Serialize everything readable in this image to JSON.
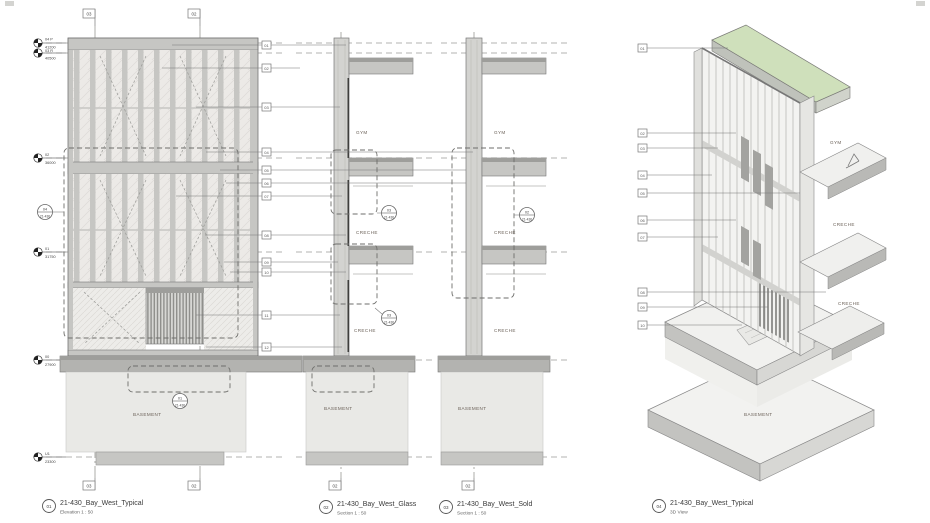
{
  "colors": {
    "roof_green": "#cfe0bb",
    "slab_gray": "#c6c6c3",
    "slab_dark": "#9e9e9b",
    "wall_fill": "#d3d3d0",
    "basement_fill": "#e9e9e6",
    "line": "#777777"
  },
  "levels": [
    {
      "name": "04 P",
      "elevation": "41200"
    },
    {
      "name": "03 R",
      "elevation": "40500"
    },
    {
      "name": "02",
      "elevation": "36000"
    },
    {
      "name": "01",
      "elevation": "31750"
    },
    {
      "name": "00",
      "elevation": "27900"
    },
    {
      "name": "U1",
      "elevation": "23300"
    }
  ],
  "grids": {
    "left": "03",
    "right": "02",
    "glass_axis": "02",
    "solid_axis": "02"
  },
  "rooms": {
    "gym": "GYM",
    "creche": "CRECHE",
    "basement": "BASEMENT"
  },
  "refs": [
    {
      "top": "04",
      "sheet": "21-430"
    },
    {
      "top": "01",
      "sheet": "21-430"
    },
    {
      "top": "03",
      "sheet": "21-430"
    },
    {
      "top": "03",
      "sheet": "21-430"
    },
    {
      "top": "02",
      "sheet": "21-430"
    }
  ],
  "keynotes_sections": [
    "01",
    "02",
    "03",
    "04",
    "05",
    "06",
    "07",
    "08",
    "09",
    "10",
    "11",
    "12"
  ],
  "keynotes_3d": [
    "01",
    "02",
    "03",
    "04",
    "05",
    "06",
    "07",
    "08",
    "09",
    "10"
  ],
  "titles": [
    {
      "num": "01",
      "name": "21-430_Bay_West_Typical",
      "sub": "Elevation  1 : 50"
    },
    {
      "num": "02",
      "name": "21-430_Bay_West_Glass",
      "sub": "Section  1 : 50"
    },
    {
      "num": "03",
      "name": "21-430_Bay_West_Sold",
      "sub": "Section  1 : 50"
    },
    {
      "num": "04",
      "name": "21-430_Bay_West_Typical",
      "sub": "3D View"
    }
  ]
}
